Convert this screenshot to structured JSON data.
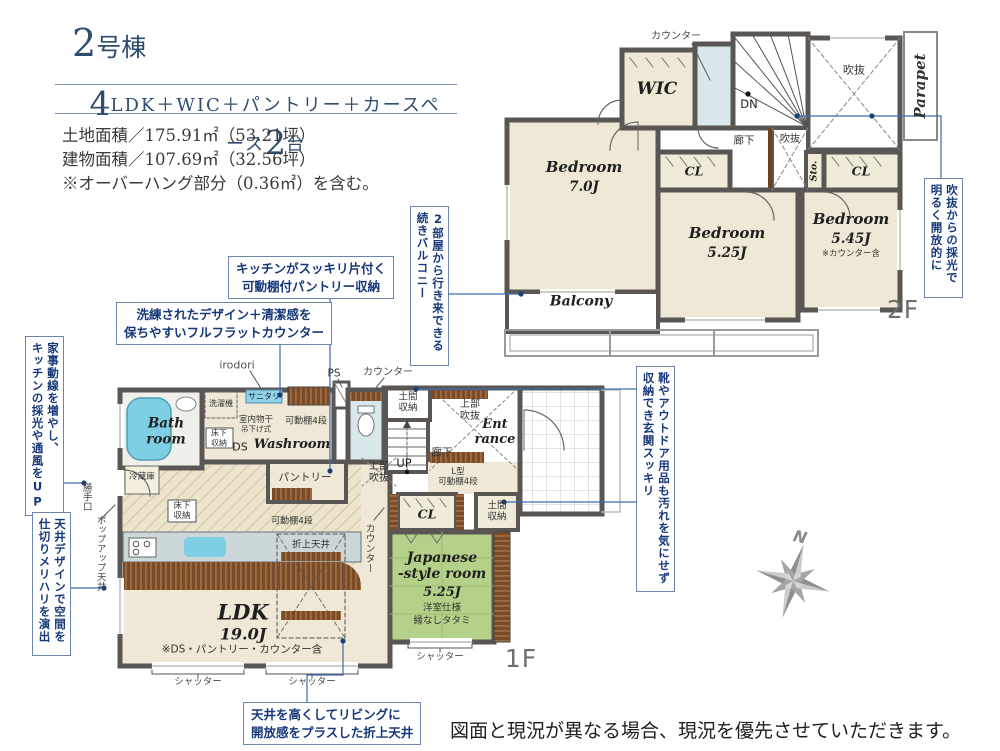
{
  "header": {
    "building_num": "2",
    "building_suffix": "号棟",
    "big1": "4",
    "mid": "LDK＋WIC＋パントリー＋カースペース",
    "big2": "2",
    "tail": "台",
    "land": "土地面積／175.91㎡（53.21坪）",
    "building": "建物面積／107.69㎡（32.56坪）",
    "note": "※オーバーハング部分（0.36㎡）を含む。"
  },
  "f2": {
    "floor": "2F",
    "counter": "カウンター",
    "wic": "WIC",
    "dn": "DN",
    "void_main": "吹抜",
    "void_stair": "吹抜",
    "hall": "廊下",
    "parapet": "Parapet",
    "bed1": "Bedroom",
    "bed1_size": "7.0J",
    "cl1": "CL",
    "sto": "Sto.",
    "cl2": "CL",
    "bed2": "Bedroom",
    "bed2_size": "5.25J",
    "bed3": "Bedroom",
    "bed3_size": "5.45J",
    "bed3_note": "※カウンター含",
    "balcony": "Balcony"
  },
  "f1": {
    "floor": "1F",
    "irodori": "irodori",
    "ps": "PS",
    "counter_top": "カウンター",
    "washer": "洗濯機",
    "sanitary": "サニタリ",
    "drying": "室内物干",
    "drying2": "吊下げ式",
    "shelf_wash": "可動棚4段",
    "doma_top": "土間\n収納",
    "void_top": "上部\n吹抜",
    "entrance": "Ent\nrance",
    "hall": "廊下",
    "up": "UP",
    "void_left": "上部\n吹抜",
    "shelf_l": "L型\n可動棚4段",
    "doma_low": "土間\n収納",
    "cl": "CL",
    "bath": "Bath\nroom",
    "underfloor_wash": "床下\n収納",
    "ds": "DS",
    "washroom": "Washroom",
    "pantry": "パントリー",
    "fridge": "冷蔵庫",
    "underfloor_kitchen": "床下\n収納",
    "shelf_pantry": "可動棚4段",
    "counter_v": "カウンター",
    "oriage": "折上天井",
    "ldk": "LDK",
    "ldk_size": "19.0J",
    "ldk_note": "※DS・パントリー・カウンター含",
    "jp_name": "Japanese\n-style room",
    "jp_size": "5.25J",
    "jp_note1": "洋室仕様",
    "jp_note2": "縁なしタタミ",
    "back_door": "勝手口",
    "popup": "ポップアップ天井",
    "shutter1": "シャッター",
    "shutter2": "シャッター",
    "shutter3": "シャッター"
  },
  "callouts": {
    "pantry_storage": "キッチンがスッキリ片付く\n可動棚付パントリー収納",
    "flat_counter": "洗練されたデザイン＋清潔感を\n保ちやすいフルフラットカウンター",
    "housework": "家事動線を増やし、\nキッチンの採光や通風をUP",
    "ceiling_design": "天井デザインで空間を\n仕切りメリハリを演出",
    "balcony_rooms": "2部屋から行き来できる\n続きバルコニー",
    "void_light": "吹抜からの採光で\n明るく開放的に",
    "genkan": "靴やアウトドア用品も汚れを気にせず\n収納でき玄関スッキリ",
    "folded_ceiling": "天井を高くしてリビングに\n開放感をプラスした折上天井"
  },
  "compass": {
    "n": "N"
  },
  "disclaimer": "図面と現況が異なる場合、現況を優先させていただきます。"
}
